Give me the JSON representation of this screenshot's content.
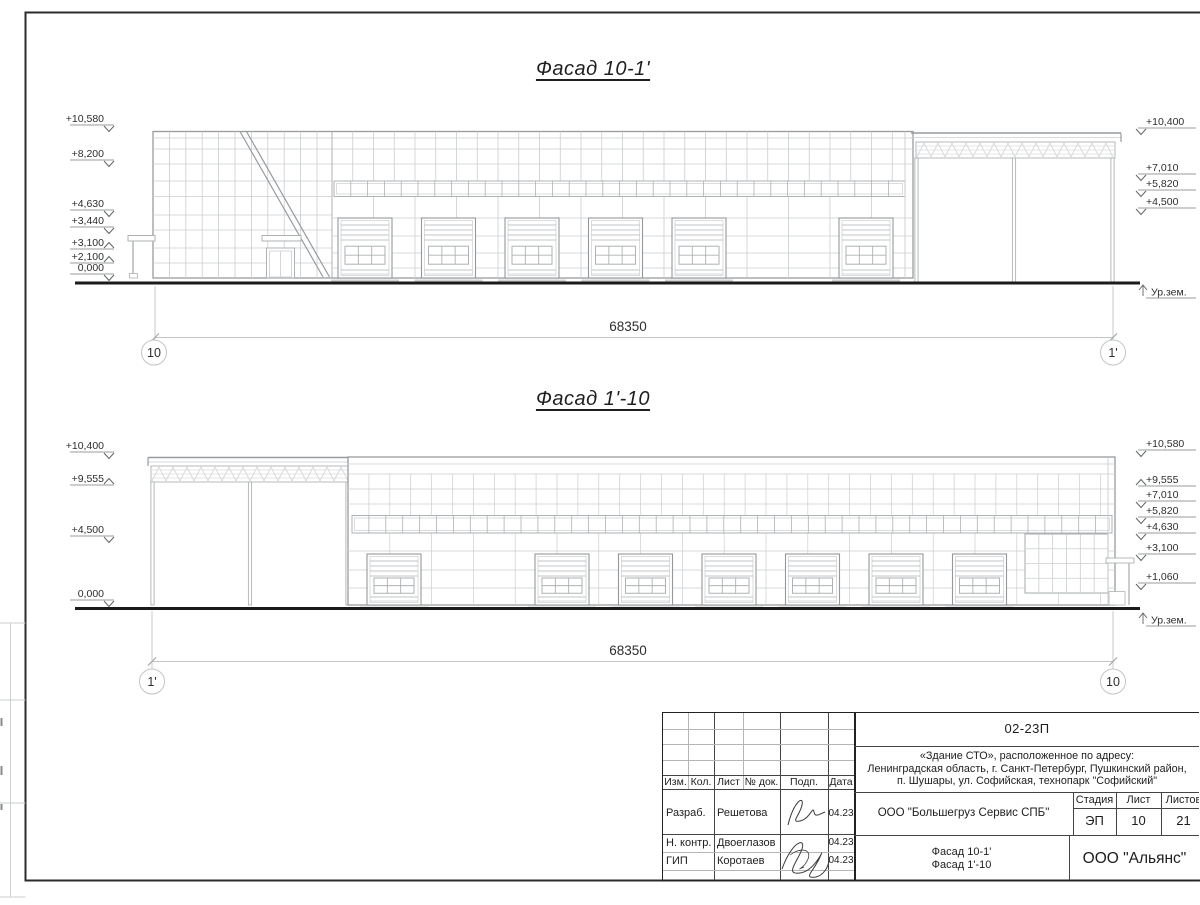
{
  "drawing": {
    "facades": [
      {
        "title": "Фасад 10-1'",
        "dimension_mm": "68350",
        "axis_left": "10",
        "axis_right": "1'",
        "ground_level_label": "Ур.зем.",
        "elevations_left": [
          "+10,580",
          "+8,200",
          "+4,630",
          "+3,440",
          "+3,100",
          "+2,100",
          "0,000"
        ],
        "elevations_right": [
          "+10,400",
          "+7,010",
          "+5,820",
          "+4,500"
        ]
      },
      {
        "title": "Фасад 1'-10",
        "dimension_mm": "68350",
        "axis_left": "1'",
        "axis_right": "10",
        "ground_level_label": "Ур.зем.",
        "elevations_left": [
          "+10,400",
          "+9,555",
          "+4,500",
          "0,000"
        ],
        "elevations_right": [
          "+10,580",
          "+9,555",
          "+7,010",
          "+5,820",
          "+4,630",
          "+3,100",
          "+1,060"
        ]
      }
    ],
    "title_block": {
      "project_code": "02-23П",
      "project_address_lines": [
        "«Здание СТО», расположенное по адресу:",
        "Ленинградская область, г. Санкт-Петербург, Пушкинский район,",
        "п. Шушары, ул. Софийская, технопарк \"Софийский\""
      ],
      "table_headers": {
        "izm": "Изм.",
        "kol": "Кол.",
        "list": "Лист",
        "doc_no": "№ док.",
        "sign": "Подп.",
        "date": "Дата"
      },
      "signature_rows": [
        {
          "role": "Разраб.",
          "name": "Решетова",
          "date": "04.23"
        },
        {
          "role": "Н. контр.",
          "name": "Двоеглазов",
          "date": "04.23"
        },
        {
          "role": "ГИП",
          "name": "Коротаев",
          "date": "04.23"
        }
      ],
      "contractor": "ООО \"Большегруз Сервис СПБ\"",
      "stage_label": "Стадия",
      "stage_value": "ЭП",
      "sheet_label": "Лист",
      "sheet_value": "10",
      "total_label": "Листов",
      "total_value": "21",
      "sheet_title_lines": [
        "Фасад 10-1'",
        "Фасад 1'-10"
      ],
      "developer": "ООО \"Альянс\""
    }
  }
}
